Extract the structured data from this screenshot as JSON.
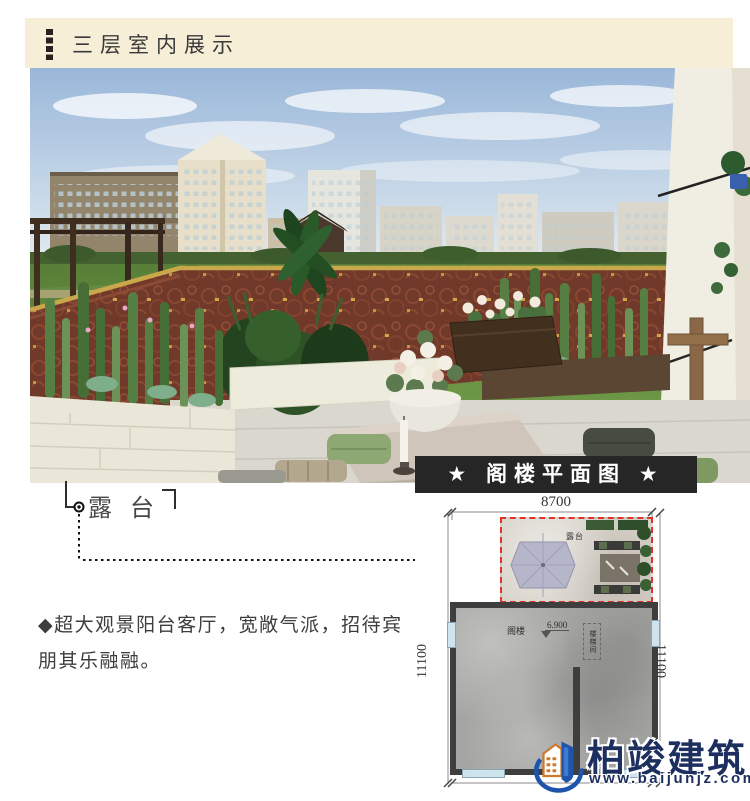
{
  "colors": {
    "band": "#f6eed6",
    "accent_dashes": "#2b2020",
    "plan_header": "#262626",
    "plan_dash_red": "#e0332a",
    "logo_navy": "#1c2f5e",
    "logo_blue": "#1d55ab",
    "logo_orange": "#cd7a2e",
    "railing_rust": "#71392a",
    "railing_gold": "#c9a84c"
  },
  "header": {
    "title": "三层室内展示"
  },
  "photo": {
    "callout_label": "露台"
  },
  "description": {
    "line1": "◆超大观景阳台客厅，宽敞气派，招待宾",
    "line2": "朋其乐融融。"
  },
  "floorplan": {
    "title": "★ 阁楼平面图 ★",
    "dimensions": {
      "top": "8700",
      "left": "11100",
      "right": "11100"
    },
    "labels": {
      "terrace": "露台",
      "room": "阁楼",
      "elevation": "6.900",
      "stair": "楼梯间"
    }
  },
  "logo": {
    "name": "柏竣建筑",
    "website": "www.baijunjz.com"
  }
}
